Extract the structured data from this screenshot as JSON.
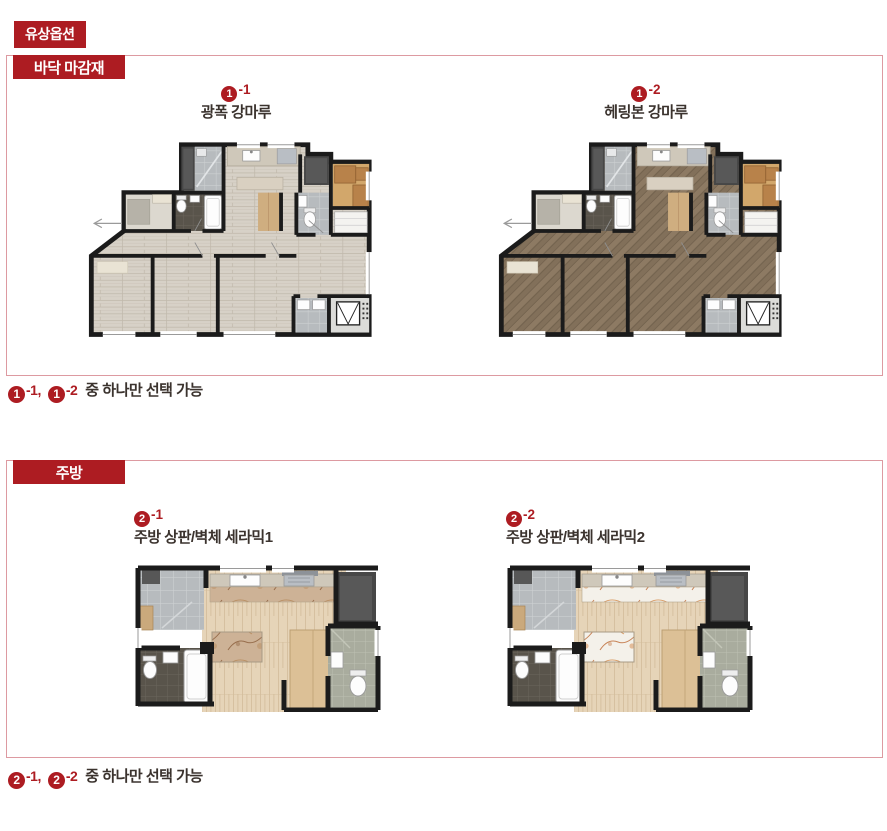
{
  "page_title_badge": "유상옵션",
  "colors": {
    "badge_red": "#ad1c22",
    "box_border_pink": "#dd9aa1",
    "ink": "#3b332e"
  },
  "sections": [
    {
      "id": "floor",
      "badge": "바닥 마감재",
      "options": [
        {
          "num": "1",
          "suffix": "-1",
          "label": "광폭 강마루",
          "variant": "plank"
        },
        {
          "num": "1",
          "suffix": "-2",
          "label": "헤링본 강마루",
          "variant": "herringbone"
        }
      ],
      "note": {
        "refs": [
          {
            "num": "1",
            "suffix": "-1,"
          },
          {
            "num": "1",
            "suffix": "-2"
          }
        ],
        "text": "중 하나만 선택 가능"
      }
    },
    {
      "id": "kitchen",
      "badge": "주방",
      "options": [
        {
          "num": "2",
          "suffix": "-1",
          "label": "주방 상판/벽체 세라믹1",
          "variant": "ceramic1"
        },
        {
          "num": "2",
          "suffix": "-2",
          "label": "주방 상판/벽체 세라믹2",
          "variant": "ceramic2"
        }
      ],
      "note": {
        "refs": [
          {
            "num": "2",
            "suffix": "-1,"
          },
          {
            "num": "2",
            "suffix": "-2"
          }
        ],
        "text": "중 하나만 선택 가능"
      }
    }
  ],
  "plan_colors": {
    "wall": "#1b1b1b",
    "plank_base": "#d7d1c7",
    "plank_line": "#c1b9ac",
    "herring_base": "#82705a",
    "herring_light": "#8d7a63",
    "herring_dark": "#6f5f4b",
    "kitchen_wood_base": "#e6d4b8",
    "kitchen_wood_line": "#d2bc9a",
    "tile_base": "#b7bbbe",
    "tile_line": "#cdd0d2",
    "dark_tile_base": "#59544b",
    "dark_tile_line": "#6b665c",
    "green_tile_base": "#a9ac9e",
    "green_tile_line": "#bdc0b3",
    "ceramic1_base": "#cdb296",
    "ceramic1_vein": "#8a5c3a",
    "ceramic1_blob": "#b98f63",
    "ceramic2_base": "#f4f1ea",
    "ceramic2_vein": "#c0703c",
    "ceramic2_blob": "#d89a62",
    "balcony_wood": "#d2a76b",
    "cabinet_wood": "#b8824a",
    "cabinet_wood_dark": "#8f5f30",
    "closet_dark": "#474747",
    "closet_inner": "#585858",
    "counter_gray": "#cfc8ba",
    "appliance_gray": "#b9bec4",
    "hood_gray": "#8d9298",
    "entry_floor": "#dcd8cf",
    "entry_mat": "#b6b2a8",
    "cream": "#e9e3d4",
    "wardrobe_wood": "#dcc096",
    "fixture_white": "#fdfdfd",
    "fixture_stroke": "#999999",
    "window_line": "#9a9a9a",
    "arrow_gray": "#9a9a9a",
    "ac_floor": "#dcdcd9"
  }
}
